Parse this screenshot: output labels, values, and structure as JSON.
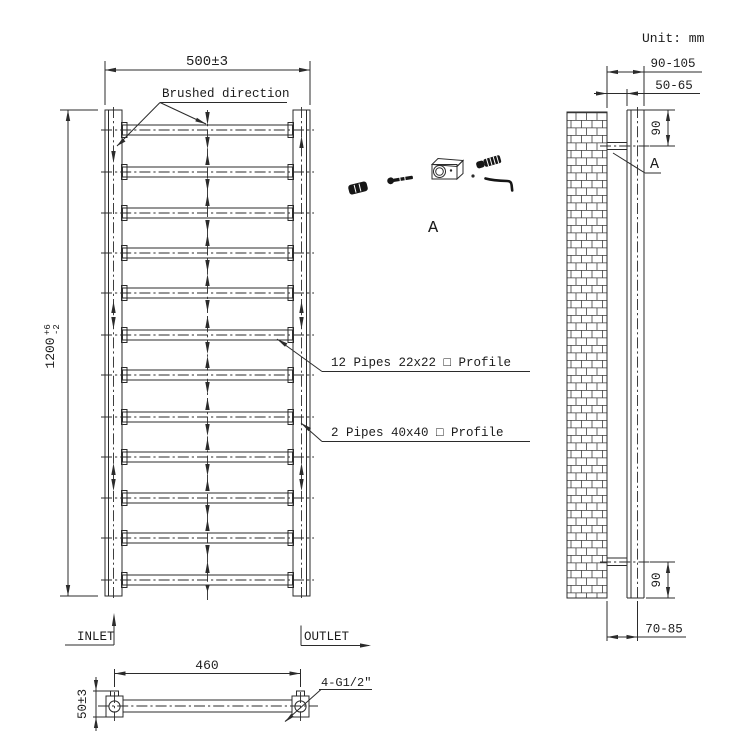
{
  "unit_label": "Unit: mm",
  "front_view": {
    "width_dim": "500±3",
    "height_dim": "1200",
    "height_tol_plus": "+6",
    "height_tol_minus": "-2",
    "brushed_label": "Brushed direction",
    "pipes_label_small": "12 Pipes 22x22 □ Profile",
    "pipes_label_large": "2 Pipes 40x40 □ Profile",
    "inlet_label": "INLET",
    "outlet_label": "OUTLET",
    "pipe_count": 12
  },
  "bottom_view": {
    "centers_dim": "460",
    "depth_dim": "50±3",
    "thread_label": "4-G1/2″"
  },
  "side_view": {
    "wall_to_front_dim": "90-105",
    "wall_gap_dim": "50-65",
    "top_bracket_dim": "90",
    "bottom_bracket_dim": "90",
    "wall_to_center_dim": "70-85",
    "detail_callout": "A"
  },
  "hardware_detail": {
    "label": "A"
  },
  "colors": {
    "line": "#2b2b2b",
    "text": "#1c1c1c",
    "background": "#ffffff"
  }
}
